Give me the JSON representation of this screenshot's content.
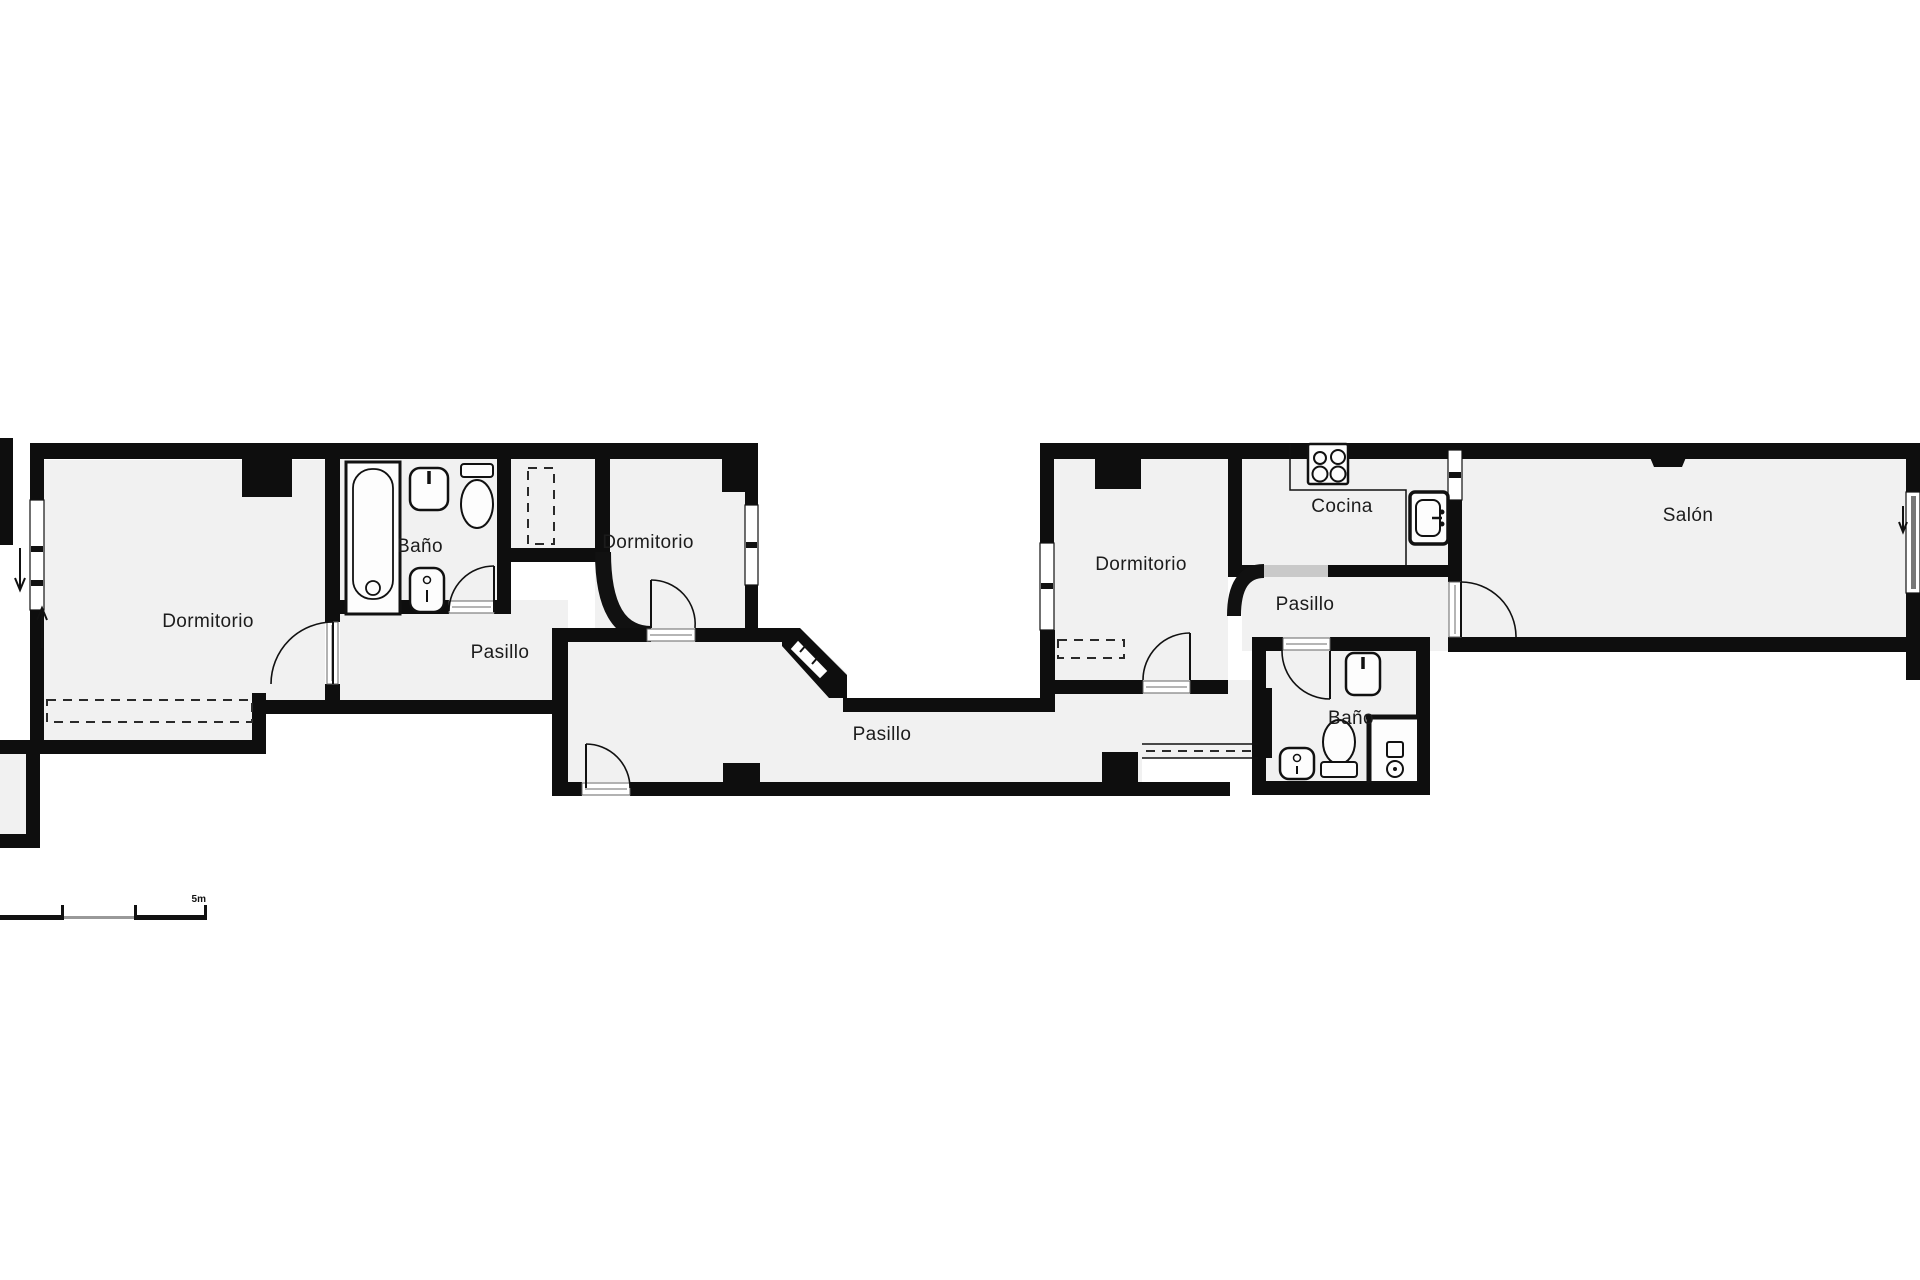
{
  "floor_plan": {
    "type": "apartment-floor-plan",
    "rooms": [
      {
        "id": "dormitorio-1",
        "label": "Dormitorio"
      },
      {
        "id": "banyo-1",
        "label": "Baño"
      },
      {
        "id": "pasillo-1",
        "label": "Pasillo"
      },
      {
        "id": "dormitorio-2",
        "label": "Dormitorio"
      },
      {
        "id": "pasillo-central",
        "label": "Pasillo"
      },
      {
        "id": "dormitorio-3",
        "label": "Dormitorio"
      },
      {
        "id": "cocina",
        "label": "Cocina"
      },
      {
        "id": "pasillo-2",
        "label": "Pasillo"
      },
      {
        "id": "banyo-2",
        "label": "Baño"
      },
      {
        "id": "salon",
        "label": "Salón"
      }
    ],
    "scale_bar": {
      "label": "5m"
    },
    "fixtures": [
      "bathtub",
      "washbasin",
      "toilet",
      "bidet",
      "stove",
      "kitchen-sink",
      "shower",
      "wardrobe-dashed"
    ],
    "colors": {
      "background": "#ffffff",
      "wall": "#0e0e0e",
      "room_fill": "#f1f1f1",
      "sliding_door": "#c9c9c9",
      "scale_bar_light": "#999999",
      "threshold_line": "#b5b5b5"
    }
  }
}
